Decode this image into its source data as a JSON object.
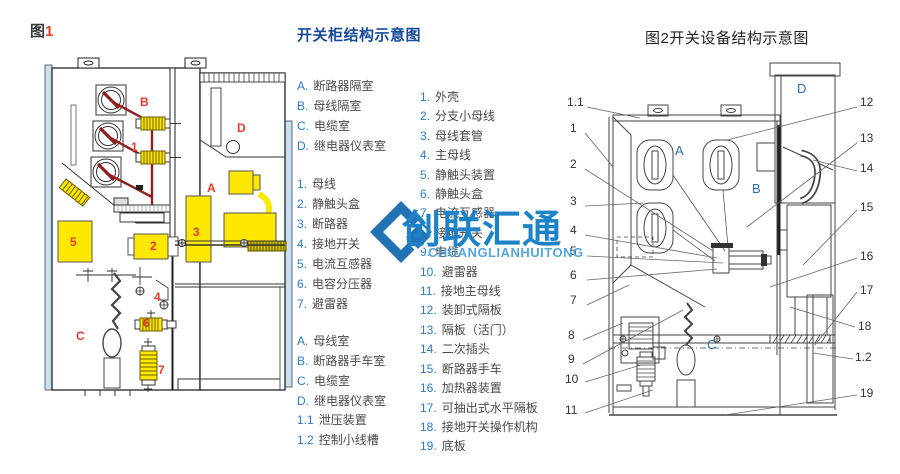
{
  "colors": {
    "legend_title_blue": "#17499c",
    "legend_prefix_blue": "#2e7bc4",
    "legend_text_gray": "#4a4a4a",
    "figure_label_red": "#e23b2e",
    "highlight_yellow": "#ffe800",
    "busbar_dark_red": "#8f1f1c",
    "panel_light_blue": "#c7e0f2",
    "watermark_blue": "#1d82c8"
  },
  "watermark": {
    "text": "创联汇通",
    "subtext": "CHUANGLIANHUITONG"
  },
  "fig1": {
    "caption_prefix": "图",
    "caption_number": "1",
    "labels": [
      "B",
      "1",
      "D",
      "A",
      "5",
      "2",
      "3",
      "4",
      "C",
      "6",
      "7"
    ]
  },
  "legend1": {
    "title": "开关柜结构示意图",
    "groups": [
      {
        "items": [
          {
            "k": "A.",
            "t": "断路器隔室"
          },
          {
            "k": "B.",
            "t": "母线隔室"
          },
          {
            "k": "C.",
            "t": "电缆室"
          },
          {
            "k": "D.",
            "t": "继电器仪表室"
          }
        ]
      },
      {
        "items": [
          {
            "k": "1.",
            "t": "母线"
          },
          {
            "k": "2.",
            "t": "静触头盒"
          },
          {
            "k": "3.",
            "t": "断路器"
          },
          {
            "k": "4.",
            "t": "接地开关"
          },
          {
            "k": "5.",
            "t": "电流互感器"
          },
          {
            "k": "6.",
            "t": "电容分压器"
          },
          {
            "k": "7.",
            "t": "避雷器"
          }
        ]
      },
      {
        "items": [
          {
            "k": "A.",
            "t": "母线室"
          },
          {
            "k": "B.",
            "t": "断路器手车室"
          },
          {
            "k": "C.",
            "t": "电缆室"
          },
          {
            "k": "D.",
            "t": "继电器仪表室"
          }
        ]
      },
      {
        "items": [
          {
            "k": "1.1",
            "t": "泄压装置"
          },
          {
            "k": "1.2",
            "t": "控制小线槽"
          }
        ]
      }
    ]
  },
  "legend2": {
    "items": [
      {
        "k": "1.",
        "t": "外壳"
      },
      {
        "k": "2.",
        "t": "分支小母线"
      },
      {
        "k": "3.",
        "t": "母线套管"
      },
      {
        "k": "4.",
        "t": "主母线"
      },
      {
        "k": "5.",
        "t": "静触头装置"
      },
      {
        "k": "6.",
        "t": "静触头盒"
      },
      {
        "k": "7.",
        "t": "电流互感器"
      },
      {
        "k": "8.",
        "t": "接地开关"
      },
      {
        "k": "9.",
        "t": "电缆"
      },
      {
        "k": "10.",
        "t": "避雷器"
      },
      {
        "k": "11.",
        "t": "接地主母线"
      },
      {
        "k": "12.",
        "t": "装卸式隔板"
      },
      {
        "k": "13.",
        "t": "隔板（活门）"
      },
      {
        "k": "14.",
        "t": "二次插头"
      },
      {
        "k": "15.",
        "t": "断路器手车"
      },
      {
        "k": "16.",
        "t": "加热器装置"
      },
      {
        "k": "17.",
        "t": "可抽出式水平隔板"
      },
      {
        "k": "18.",
        "t": "接地开关操作机构"
      },
      {
        "k": "19.",
        "t": "底板"
      }
    ]
  },
  "fig2": {
    "title": "图2开关设备结构示意图",
    "callouts_left": [
      "1.1",
      "1",
      "2",
      "3",
      "4",
      "5",
      "6",
      "7",
      "8",
      "9",
      "10",
      "11"
    ],
    "callouts_right": [
      "12",
      "13",
      "14",
      "15",
      "16",
      "17",
      "18",
      "1.2",
      "19"
    ],
    "zones": [
      "A",
      "B",
      "C",
      "D"
    ]
  }
}
